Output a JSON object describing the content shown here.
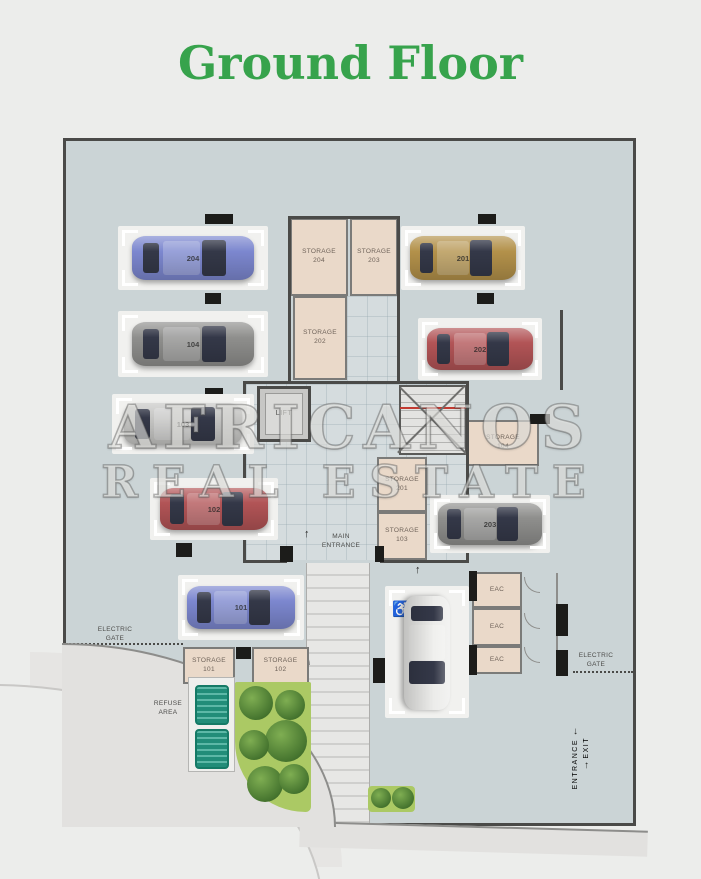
{
  "title": "Ground Floor",
  "watermark": {
    "line1": "AFRICANOS",
    "line2": "REAL ESTATE"
  },
  "stalls": [
    {
      "number": "204",
      "car_color": "blue"
    },
    {
      "number": "104",
      "car_color": "gray"
    },
    {
      "number": "103",
      "car_color": "silver"
    },
    {
      "number": "102",
      "car_color": "red"
    },
    {
      "number": "101",
      "car_color": "blue"
    },
    {
      "number": "201",
      "car_color": "gold"
    },
    {
      "number": "202",
      "car_color": "red"
    },
    {
      "number": "203",
      "car_color": "gray"
    },
    {
      "number": "",
      "car_color": "white"
    }
  ],
  "storages": {
    "s204": {
      "line1": "STORAGE",
      "line2": "204"
    },
    "s203": {
      "line1": "STORAGE",
      "line2": "203"
    },
    "s202": {
      "line1": "STORAGE",
      "line2": "202"
    },
    "s104": {
      "line1": "STORAGE",
      "line2": "104"
    },
    "s201": {
      "line1": "STORAGE",
      "line2": "201"
    },
    "s103": {
      "line1": "STORAGE",
      "line2": "103"
    },
    "s101": {
      "line1": "STORAGE",
      "line2": "101"
    },
    "s102": {
      "line1": "STORAGE",
      "line2": "102"
    }
  },
  "rooms": {
    "lift": "LIFT",
    "eac": "EAC",
    "main_line1": "MAIN",
    "main_line2": "ENTRANCE",
    "refuse_line1": "REFUSE",
    "refuse_line2": "AREA"
  },
  "gates": {
    "electric_line1": "ELECTRIC",
    "electric_line2": "GATE",
    "entrance": "ENTRANCE",
    "exit": "EXIT",
    "arrow_down": "↓",
    "arrow_up": "↑"
  },
  "icons": {
    "wheelchair": "♿"
  },
  "colors": {
    "title_green": "#37a34c",
    "plan_background": "#cbd4d6",
    "storage_fill": "#ead9c9",
    "car_blue": "#7c87cf",
    "car_gray": "#8f8f8d",
    "car_silver": "#c6c6c4",
    "car_red": "#b25456",
    "car_gold": "#b3914a",
    "car_white": "#ececea",
    "road_fill": "#e2e1df",
    "green_area": "#abc964"
  }
}
